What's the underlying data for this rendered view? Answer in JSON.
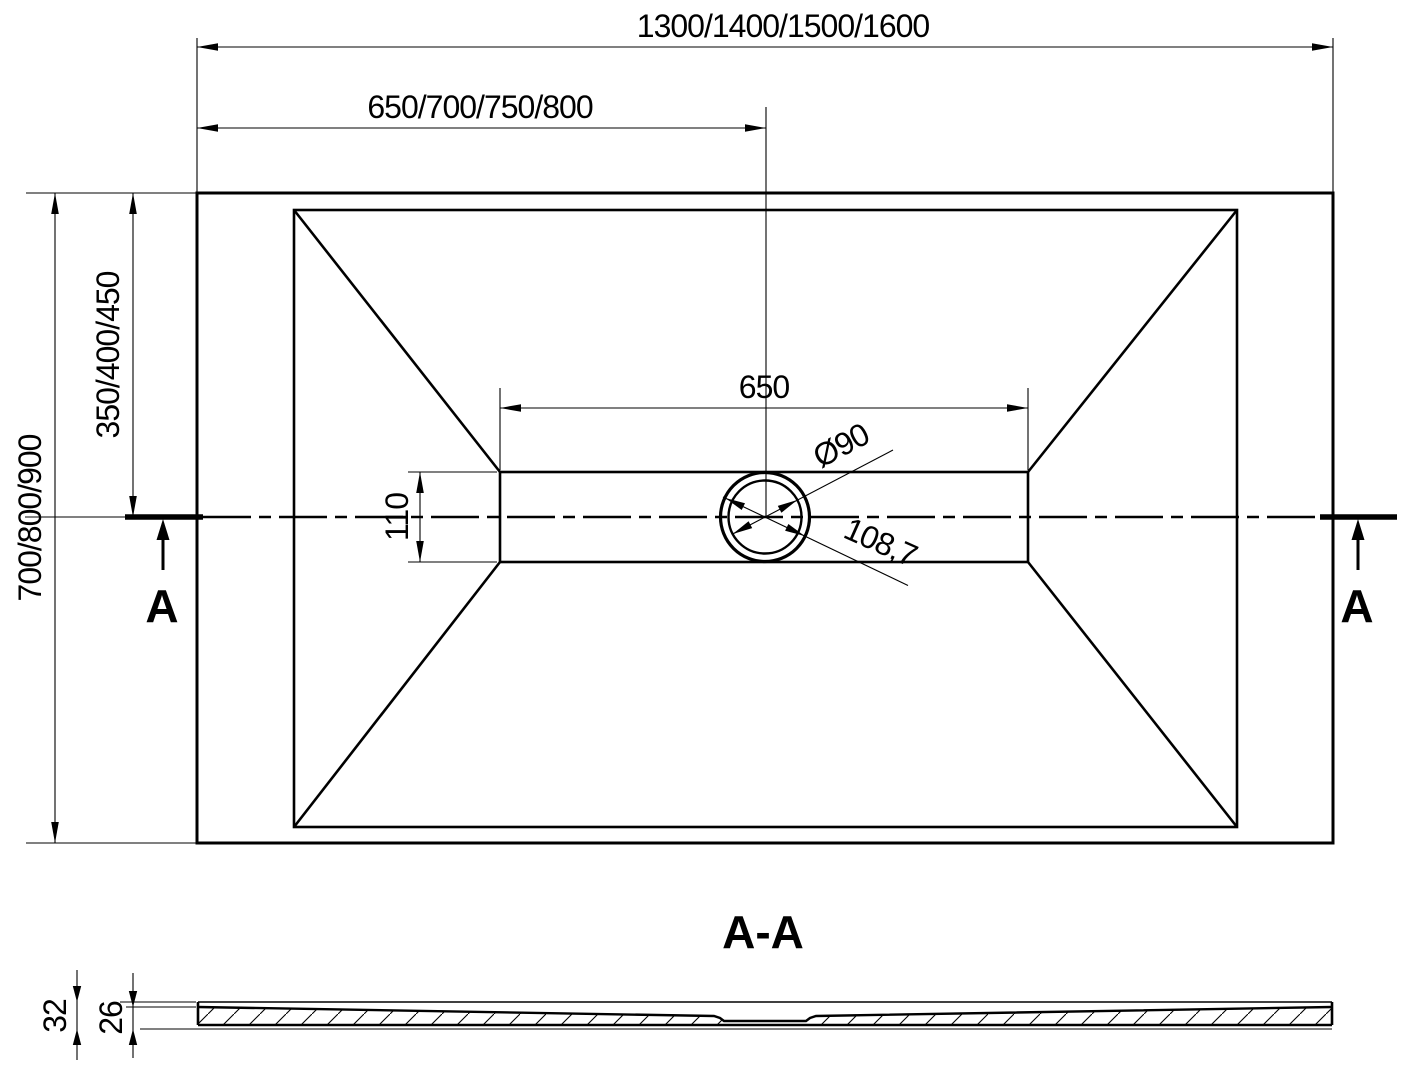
{
  "plan_view": {
    "dim_overall_width": "1300/1400/1500/1600",
    "dim_center_width": "650/700/750/800",
    "dim_overall_depth": "700/800/900",
    "dim_center_depth": "350/400/450",
    "dim_channel_length": "650",
    "dim_channel_width": "110",
    "dim_drain_diameter": "Ø90",
    "dim_drain_outer_diameter": "108,7",
    "section_marker_left": "A",
    "section_marker_right": "A"
  },
  "section_view": {
    "title": "A-A",
    "dim_total_height": "32",
    "dim_inner_height": "26"
  },
  "colors": {
    "line": "#000000",
    "background": "#ffffff"
  }
}
